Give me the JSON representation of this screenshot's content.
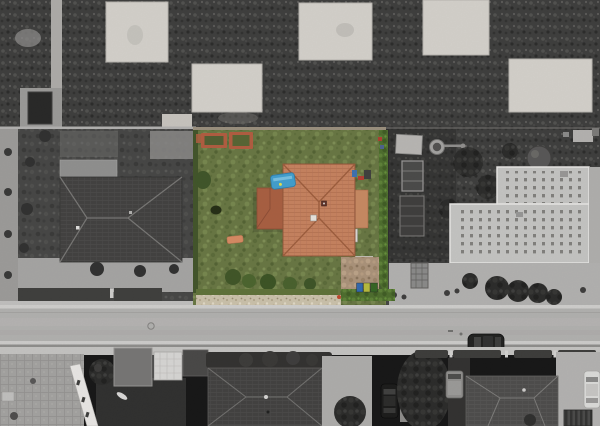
{
  "image": {
    "kind": "aerial-drone-photograph",
    "style": "selective-color-highlight",
    "subject": "detached house with terracotta hip roof and green garden; surrounding neighborhood desaturated to grayscale"
  },
  "colors": {
    "lawn_green": "#66753f",
    "roof_orange": "#c8815c",
    "roof_tile_line": "#b06a48",
    "garage_roof": "#a95c3d",
    "wing_roof": "#c9885f",
    "hedge_green": "#4a6b28",
    "hedge_dark": "#3e5125",
    "low_hedge": "#5c7034",
    "gravel_tan": "#cdc3ab",
    "dirt_tan": "#ab9278",
    "brick_bed": "#b25a3c",
    "bed_soil": "#4e5c2e",
    "pool_blue": "#3e9fd0",
    "bin_blue": "#2e66ae",
    "bin_yellow": "#b8bc38",
    "bin_green": "#31631f",
    "bench_orange": "#d98a60",
    "field_dark": "#3a3a39",
    "pad_light": "#d6d3cd",
    "road_gray": "#b2b1af",
    "sidewalk_gray": "#c6c5c3",
    "cobble_gray": "#a3a2a0",
    "paving_gray": "#9c9b99",
    "lawn_gray": "#424241",
    "roof_dark_left": "#3e3d3c",
    "roof_dark_bottom": "#4a4948",
    "building_light": "#c6c6c4",
    "tree_dark": "#262625",
    "car_dark": "#1c1c1b",
    "car_white": "#dededc",
    "van_gray": "#8f8e8c",
    "wall_white": "#eceae7",
    "cube_white": "#d9d8d6"
  }
}
